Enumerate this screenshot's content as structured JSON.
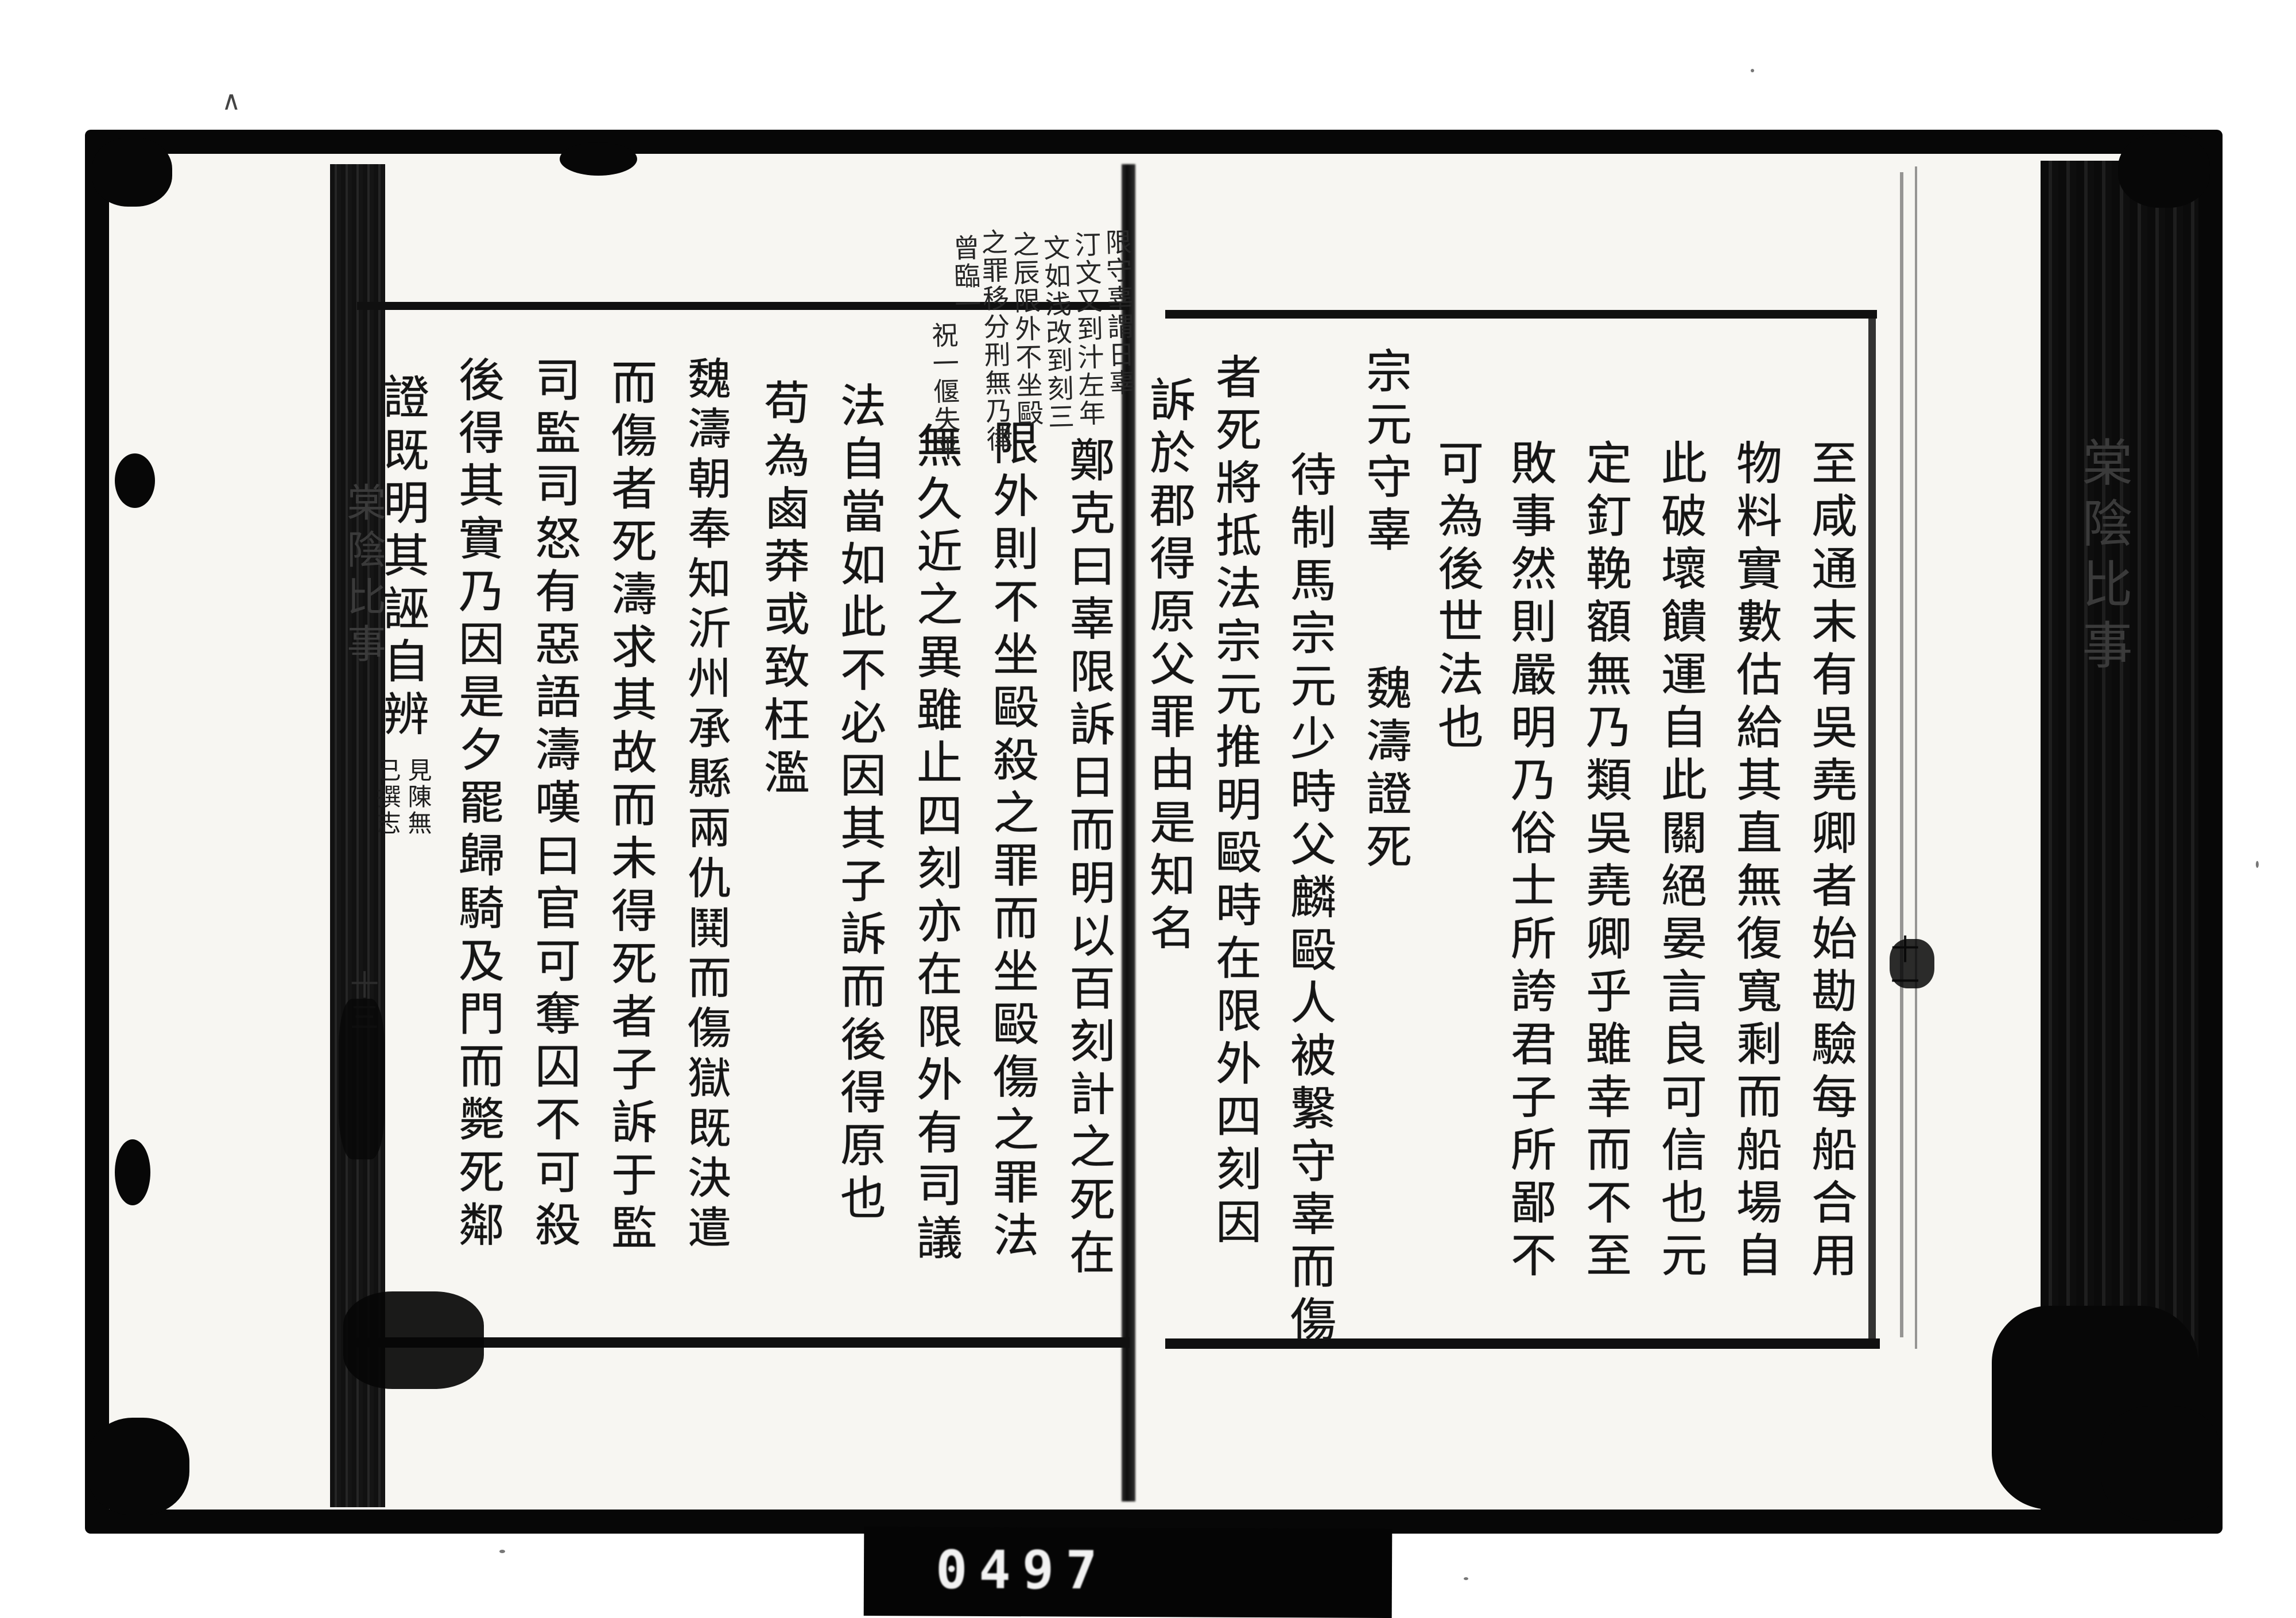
{
  "film": {
    "counter": "0497",
    "stray_mark": "∧"
  },
  "right_page": {
    "edge_title": "棠陰比事",
    "leaf_number": "十一",
    "columns": [
      "至咸通末有吳堯卿者始勘驗每船合用",
      "物料實數估給其直無復寬剩而船場自",
      "此破壞饋運自此關絕晏言良可信也元",
      "定釘鞔額無乃類吳堯卿乎雖幸而不至",
      "敗事然則嚴明乃俗士所誇君子所鄙不",
      "可為後世法也",
      "宗元守辜　　魏濤證死",
      "待制馬宗元少時父麟毆人被繫守辜而傷",
      "者死將抵法宗元推明毆時在限外四刻因",
      "訴於郡得原父罪由是知名"
    ]
  },
  "left_page": {
    "edge_title": "棠陰比事",
    "leaf_number": "十三",
    "columns": [
      "鄭克曰辜限訴日而明以百刻計之死在",
      "限外則不坐毆殺之罪而坐毆傷之罪法",
      "無久近之異雖止四刻亦在限外有司議",
      "法自當如此不必因其子訴而後得原也",
      "苟為鹵莽或致枉濫",
      "魏濤朝奉知沂州承縣兩仇鬨而傷獄既決遣",
      "而傷者死濤求其故而未得死者子訴于監",
      "司監司怒有惡語濤嘆曰官可奪囚不可殺",
      "後得其實乃因是夕罷歸騎及門而斃死鄰",
      "證既明其誣自辨"
    ],
    "note_columns": [
      "見陳無",
      "己撰志"
    ],
    "marginalia": [
      "限守辜謂日辜",
      "汀文又到汁左年",
      "文如浅改到刻三",
      "之辰限外不坐毆",
      "之罪移分刑無乃律",
      "曾臨一",
      "祝一偃失平"
    ]
  }
}
